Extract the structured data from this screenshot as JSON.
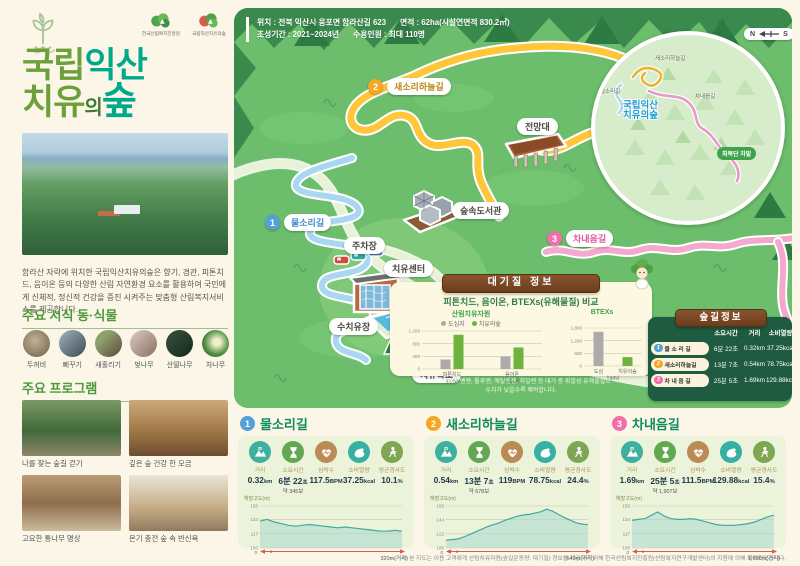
{
  "sidebar": {
    "logos": [
      {
        "name": "한국산림복지진흥원"
      },
      {
        "name": "국립익산치유의숲"
      }
    ],
    "title": {
      "l1a": "국립",
      "l1b": "익산",
      "l2a": "치유",
      "l2b": "의",
      "l2c": "숲"
    },
    "description": "함라산 자락에 위치한 국립익산치유의숲은 향기, 경관, 피톤치드, 음이온 등의 다양한 산림 자연환경 요소를 활용하여 국민에게 신체적, 정신적 건강을 증진 시켜주는 맞춤형 산림복지서비스를 제공합니다.",
    "species_heading": "주요 서식 동·식물",
    "species": [
      {
        "name": "두꺼비"
      },
      {
        "name": "뻐꾸기"
      },
      {
        "name": "새홀리기"
      },
      {
        "name": "벚나무"
      },
      {
        "name": "산딸나무"
      },
      {
        "name": "차나무"
      }
    ],
    "programs_heading": "주요 프로그램",
    "programs": [
      {
        "caption": "나를 찾는 숲길 걷기"
      },
      {
        "caption": "깊은 숲 건강 한 모금"
      },
      {
        "caption": "고요한 통나무 명상"
      },
      {
        "caption": "온기 충전 숲 속 반신욕"
      }
    ]
  },
  "map": {
    "info": {
      "location": "위치 : 전북 익산시 웅포면 함라산길 623",
      "area": "면적 : 62ha(시설연면적 830.2㎡)",
      "period": "조성기간 : 2021~2024년",
      "capacity": "수용인원 : 최대 110명"
    },
    "trails": [
      {
        "num": "1",
        "label": "물소리길"
      },
      {
        "num": "2",
        "label": "새소리하늘길"
      },
      {
        "num": "3",
        "label": "차내음길"
      }
    ],
    "places": {
      "observatory": "전망대",
      "library": "숲속도서관",
      "parking": "주차장",
      "center": "치유센터",
      "water_healing": "수치유장",
      "waterfall": "치유폭포"
    },
    "inset": {
      "trail2": "새소리하늘길",
      "trail1": "물소리길",
      "name1": "국립익산",
      "name2": "치유의숲",
      "trail3": "차내음길",
      "tea_field": "최북단 차밭",
      "compass_n": "N",
      "compass_s": "S"
    }
  },
  "air": {
    "ribbon": "대기질 정보",
    "subtitle": "피톤치드, 음이온, BTEXs(유해물질) 비교",
    "note1": "※BTEXs : 벤젠, 톨루엔, 에틸벤젠, 자일렌 등 대기 중 휘발성 유해물질로",
    "note2": "수치가 낮을수록 쾌적합니다."
  },
  "trail_table": {
    "ribbon": "숲길정보",
    "headers": [
      "소요시간",
      "거리",
      "소비열량"
    ],
    "rows": [
      {
        "num": "1",
        "name": "물 소 리 길",
        "time": "6분 22초",
        "dist": "0.32km",
        "kcal": "37.25kcal"
      },
      {
        "num": "2",
        "name": "새소리하늘길",
        "time": "13분 7초",
        "dist": "0.54km",
        "kcal": "78.75kcal"
      },
      {
        "num": "3",
        "name": "차 내 음 길",
        "time": "25분 5초",
        "dist": "1.69km",
        "kcal": "129.88kcal"
      }
    ]
  },
  "cards": [
    {
      "num": "1",
      "title": "물소리길",
      "stats": [
        {
          "label": "거리",
          "value": "0.32",
          "unit": "km",
          "sub": ""
        },
        {
          "label": "소요시간",
          "value": "6분 22",
          "unit": "초",
          "sub": "약 345보"
        },
        {
          "label": "심박수",
          "value": "117.5",
          "unit": "BPM",
          "sub": ""
        },
        {
          "label": "소비열량",
          "value": "37.25",
          "unit": "kcal",
          "sub": ""
        },
        {
          "label": "평균경사도",
          "value": "10.1",
          "unit": "%",
          "sub": ""
        }
      ]
    },
    {
      "num": "2",
      "title": "새소리하늘길",
      "stats": [
        {
          "label": "거리",
          "value": "0.54",
          "unit": "km",
          "sub": ""
        },
        {
          "label": "소요시간",
          "value": "13분 7",
          "unit": "초",
          "sub": "약 678보"
        },
        {
          "label": "심박수",
          "value": "119",
          "unit": "BPM",
          "sub": ""
        },
        {
          "label": "소비열량",
          "value": "78.75",
          "unit": "kcal",
          "sub": ""
        },
        {
          "label": "평균경사도",
          "value": "24.4",
          "unit": "%",
          "sub": ""
        }
      ]
    },
    {
      "num": "3",
      "title": "차내음길",
      "stats": [
        {
          "label": "거리",
          "value": "1.69",
          "unit": "km",
          "sub": ""
        },
        {
          "label": "소요시간",
          "value": "25분 5",
          "unit": "초",
          "sub": "약 1,907보"
        },
        {
          "label": "심박수",
          "value": "111.5",
          "unit": "BPM",
          "sub": ""
        },
        {
          "label": "소비열량",
          "value": "129.88",
          "unit": "kcal",
          "sub": ""
        },
        {
          "label": "평균경사도",
          "value": "15.4",
          "unit": "%",
          "sub": ""
        }
      ]
    }
  ],
  "footer": "※ 본 지도는 이용 고객에게 산림치유자원(숲길운동량, 대기질) 정보를 제공하기 위해 한국산림복지진흥원(산림복지연구개발센터)의 지원에 의해 제작되었습니다.",
  "chart_data": [
    {
      "type": "bar",
      "title": "산림치유자원",
      "categories": [
        "피톤치드\n(pptv)",
        "음이온\n(개/㎤)"
      ],
      "series": [
        {
          "name": "도심지",
          "color": "#ABABAB",
          "values": [
            300,
            390
          ]
        },
        {
          "name": "치유의숲",
          "color": "#6CB33F",
          "values": [
            1080,
            680
          ]
        }
      ],
      "yticks": [
        0,
        400,
        800,
        1200
      ],
      "ylim": [
        0,
        1200
      ]
    },
    {
      "type": "bar",
      "title": "BTEXs",
      "bars": [
        {
          "label": "도심",
          "value": 1620,
          "color": "#ABABAB"
        },
        {
          "label": "치유의숲",
          "value": 420,
          "color": "#6CB33F"
        }
      ],
      "yticks": [
        0,
        600,
        1200,
        1800
      ],
      "ylim": [
        0,
        1800
      ],
      "xunit": "(pptv)"
    },
    {
      "type": "area",
      "title": "물소리길 고도 프로파일",
      "ylabel": "해발고도(m)",
      "yticks": [
        100,
        117,
        134,
        150
      ],
      "ylim": [
        100,
        150
      ],
      "x_end_label": "320m(거리)",
      "values": [
        132,
        134,
        131,
        129,
        127,
        126,
        127,
        128,
        127,
        126,
        125,
        124,
        125,
        124,
        123,
        122,
        121,
        120,
        120,
        121,
        120
      ]
    },
    {
      "type": "area",
      "title": "새소리하늘길 고도 프로파일",
      "ylabel": "해발고도(m)",
      "yticks": [
        100,
        122,
        144,
        165
      ],
      "ylim": [
        100,
        165
      ],
      "x_end_label": "540m(거리)",
      "values": [
        112,
        113,
        114,
        117,
        121,
        125,
        129,
        133,
        136,
        139,
        143,
        146,
        149,
        151,
        152,
        154,
        156,
        160,
        157,
        152,
        147,
        143,
        139,
        137,
        136
      ]
    },
    {
      "type": "area",
      "title": "차내음길 고도 프로파일",
      "ylabel": "해발고도(m)",
      "yticks": [
        100,
        117,
        134,
        150
      ],
      "ylim": [
        100,
        150
      ],
      "x_end_label": "1,690m(거리)",
      "values": [
        133,
        134,
        135,
        139,
        143,
        138,
        135,
        134,
        134,
        135,
        134,
        132,
        130,
        128,
        127,
        127,
        127,
        128,
        129,
        131,
        134,
        137,
        139
      ]
    }
  ]
}
